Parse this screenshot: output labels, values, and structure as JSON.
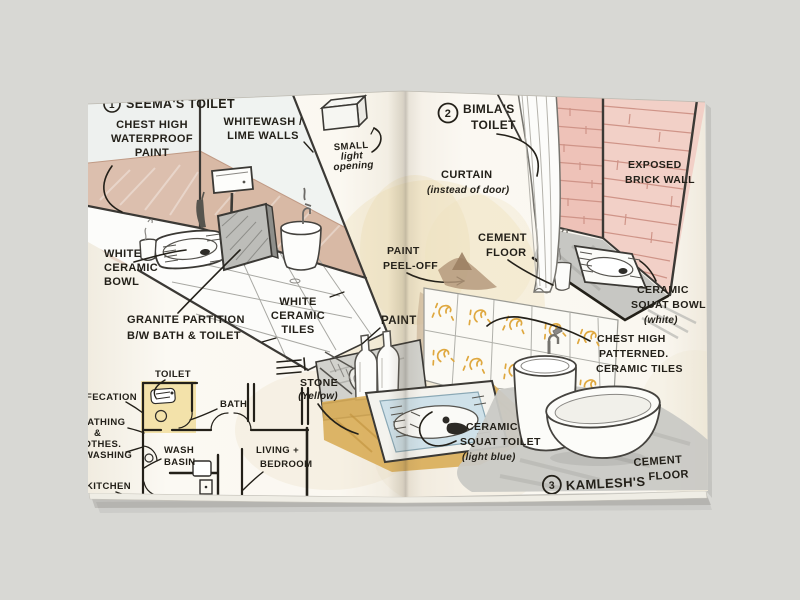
{
  "document_type": "hand-drawn toilet design sketchbook spread",
  "seema": {
    "number": "1",
    "title": "SEEMA'S TOILET",
    "chest_high": [
      "CHEST HIGH",
      "WATERPROOF",
      "PAINT"
    ],
    "whitewash": [
      "WHITEWASH /",
      "LIME WALLS"
    ],
    "small_light": [
      "SMALL",
      "light",
      "opening"
    ],
    "white_bowl": [
      "WHITE",
      "CERAMIC",
      "BOWL"
    ],
    "granite": [
      "GRANITE PARTITION",
      "B/W BATH & TOILET"
    ],
    "white_tiles": [
      "WHITE",
      "CERAMIC",
      "TILES"
    ]
  },
  "floorplan": {
    "toilet": "TOILET",
    "defecation": "DEFECATION",
    "bath": "BATH",
    "bathing": [
      "BATHING",
      "&",
      "CLOTHES.",
      "WASHING"
    ],
    "wash_basin": [
      "WASH",
      "BASIN"
    ],
    "living": [
      "LIVING +",
      "BEDROOM"
    ],
    "kitchen": "KITCHEN"
  },
  "bimla": {
    "number": "2",
    "title": [
      "BIMLA'S",
      "TOILET"
    ],
    "curtain": [
      "CURTAIN",
      "(instead of door)"
    ],
    "exposed_brick": [
      "EXPOSED",
      "BRICK WALL"
    ],
    "cement_floor": [
      "CEMENT",
      "FLOOR"
    ],
    "paint_peel": [
      "PAINT",
      "PEEL-OFF"
    ],
    "squat_bowl": [
      "CERAMIC",
      "SQUAT BOWL",
      "(white)"
    ]
  },
  "kamlesh": {
    "number": "3",
    "title": "KAMLESH'S",
    "paint": "PAINT",
    "stone": [
      "STONE",
      "(Yellow)"
    ],
    "squat_toilet": [
      "CERAMIC",
      "SQUAT TOILET",
      "(light blue)"
    ],
    "patterned_tiles": [
      "CHEST HIGH",
      "PATTERNED.",
      "CERAMIC TILES"
    ],
    "cement_floor": [
      "CEMENT",
      "FLOOR"
    ]
  },
  "colors": {
    "background": "#d8d8d4",
    "page": "#fbf8f1",
    "ink": "#232019",
    "wall_paint_tan": "#dcbfae",
    "brick_pink_left": "#eec2b8",
    "brick_pink_right": "#f2d0c7",
    "brick_line": "#c98d80",
    "cement_gray": "#c7c7c3",
    "stone_yellow": "#d9ad58",
    "tile_motif_yellow": "#dfa83f",
    "plan_highlight_yellow": "#f2dfa2",
    "toilet_light_blue": "#cfe1e9",
    "granite_gray": "#bdbdb9"
  }
}
